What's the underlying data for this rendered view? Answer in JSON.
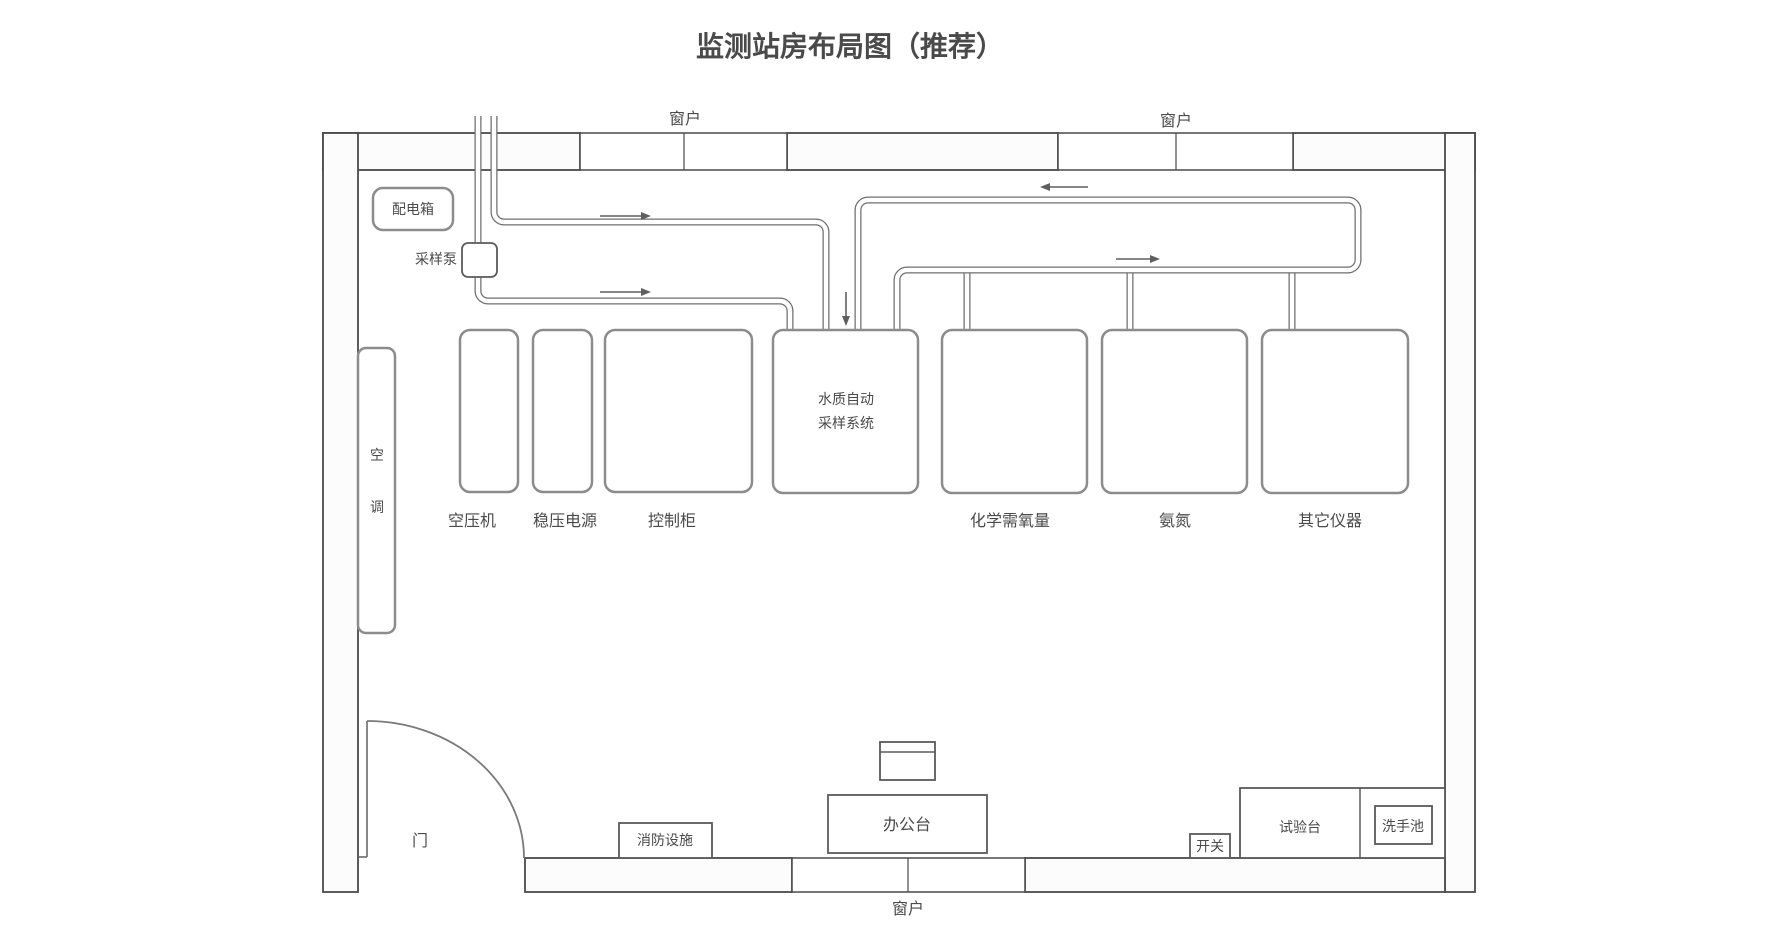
{
  "title": "监测站房布局图（推荐）",
  "colors": {
    "title": "#2b5c8f",
    "line": "#6e6e6e",
    "wall": "#4a4a4a"
  },
  "labels": {
    "window": "窗户",
    "distribution_box": "配电箱",
    "sampling_pump": "采样泵",
    "air_conditioner_chars": [
      "空",
      "调"
    ],
    "air_compressor": "空压机",
    "regulated_power_supply": "稳压电源",
    "control_cabinet": "控制柜",
    "water_sampler_line1": "水质自动",
    "water_sampler_line2": "采样系统",
    "cod_analyzer": "化学需氧量",
    "ammonia_analyzer": "氨氮",
    "other_instruments": "其它仪器",
    "door": "门",
    "fire_equipment": "消防设施",
    "office_desk": "办公台",
    "switch": "开关",
    "test_bench": "试验台",
    "wash_basin": "洗手池"
  }
}
